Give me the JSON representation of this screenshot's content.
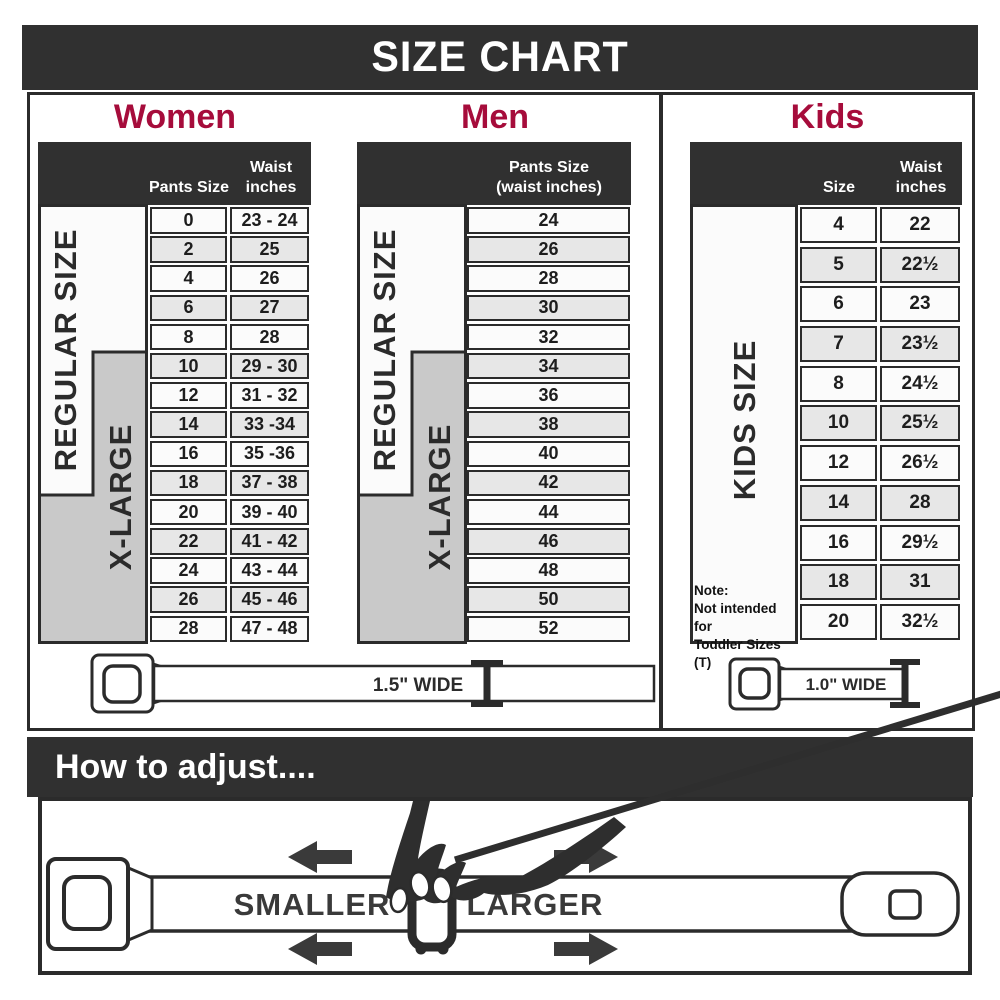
{
  "title": "SIZE CHART",
  "colors": {
    "banner_bg": "#303030",
    "accent_red": "#a60c3b",
    "border_dark": "#2b2b2b",
    "cell_light": "#fbfbfb",
    "cell_gray": "#e7e7e7",
    "xlarge_gray": "#c9c9c9"
  },
  "women": {
    "title": "Women",
    "col1_header": "Pants Size",
    "col2_header_line1": "Waist",
    "col2_header_line2": "inches",
    "regular_label": "REGULAR SIZE",
    "xlarge_label": "X-LARGE",
    "rows": [
      {
        "size": "0",
        "waist": "23 - 24"
      },
      {
        "size": "2",
        "waist": "25"
      },
      {
        "size": "4",
        "waist": "26"
      },
      {
        "size": "6",
        "waist": "27"
      },
      {
        "size": "8",
        "waist": "28"
      },
      {
        "size": "10",
        "waist": "29 - 30"
      },
      {
        "size": "12",
        "waist": "31 - 32"
      },
      {
        "size": "14",
        "waist": "33 -34"
      },
      {
        "size": "16",
        "waist": "35 -36"
      },
      {
        "size": "18",
        "waist": "37 - 38"
      },
      {
        "size": "20",
        "waist": "39 - 40"
      },
      {
        "size": "22",
        "waist": "41 - 42"
      },
      {
        "size": "24",
        "waist": "43 - 44"
      },
      {
        "size": "26",
        "waist": "45 - 46"
      },
      {
        "size": "28",
        "waist": "47 - 48"
      }
    ]
  },
  "men": {
    "title": "Men",
    "col_header_line1": "Pants Size",
    "col_header_line2": "(waist inches)",
    "regular_label": "REGULAR SIZE",
    "xlarge_label": "X-LARGE",
    "rows": [
      "24",
      "26",
      "28",
      "30",
      "32",
      "34",
      "36",
      "38",
      "40",
      "42",
      "44",
      "46",
      "48",
      "50",
      "52"
    ]
  },
  "kids": {
    "title": "Kids",
    "col1_header": "Size",
    "col2_header_line1": "Waist",
    "col2_header_line2": "inches",
    "kids_label": "KIDS SIZE",
    "note_line1": "Note:",
    "note_line2": "Not intended for",
    "note_line3": "Toddler Sizes (T)",
    "rows": [
      {
        "size": "4",
        "waist": "22"
      },
      {
        "size": "5",
        "waist": "22½"
      },
      {
        "size": "6",
        "waist": "23"
      },
      {
        "size": "7",
        "waist": "23½"
      },
      {
        "size": "8",
        "waist": "24½"
      },
      {
        "size": "10",
        "waist": "25½"
      },
      {
        "size": "12",
        "waist": "26½"
      },
      {
        "size": "14",
        "waist": "28"
      },
      {
        "size": "16",
        "waist": "29½"
      },
      {
        "size": "18",
        "waist": "31"
      },
      {
        "size": "20",
        "waist": "32½"
      }
    ]
  },
  "belts": {
    "adult_width_label": "1.5\" WIDE",
    "kids_width_label": "1.0\" WIDE"
  },
  "adjust": {
    "title": "How to adjust....",
    "smaller_label": "SMALLER",
    "larger_label": "LARGER"
  }
}
